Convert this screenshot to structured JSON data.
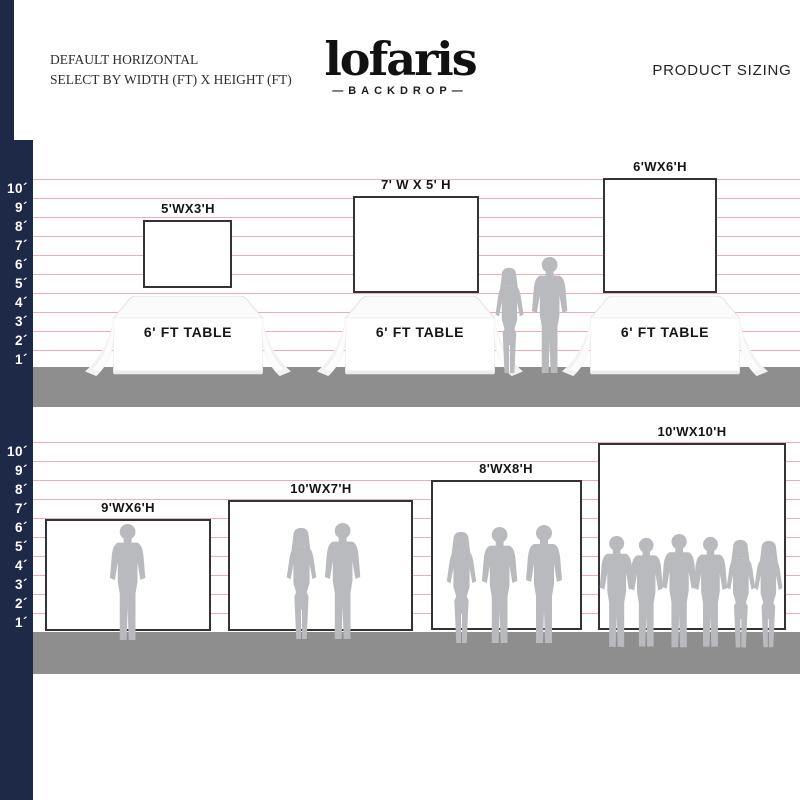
{
  "header": {
    "line1": "DEFAULT HORIZONTAL",
    "line2": "SELECT BY WIDTH (FT) X HEIGHT (FT)",
    "logo": "lofaris",
    "logo_sub": "—BACKDROP—",
    "right": "PRODUCT SIZING"
  },
  "scale": {
    "unit": "ft",
    "labels": [
      "10´",
      "9´",
      "8´",
      "7´",
      "6´",
      "5´",
      "4´",
      "3´",
      "2´",
      "1´"
    ]
  },
  "top_section": {
    "backdrops": [
      {
        "label": "5'WX3'H",
        "width_ft": 5,
        "height_ft": 3
      },
      {
        "label": "7' W X 5' H",
        "width_ft": 7,
        "height_ft": 5
      },
      {
        "label": "6'WX6'H",
        "width_ft": 6,
        "height_ft": 6
      }
    ],
    "tables": [
      {
        "label": "6' FT TABLE"
      },
      {
        "label": "6' FT TABLE"
      },
      {
        "label": "6' FT TABLE"
      }
    ]
  },
  "bottom_section": {
    "backdrops": [
      {
        "label": "9'WX6'H",
        "width_ft": 9,
        "height_ft": 6
      },
      {
        "label": "10'WX7'H",
        "width_ft": 10,
        "height_ft": 7
      },
      {
        "label": "8'WX8'H",
        "width_ft": 8,
        "height_ft": 8
      },
      {
        "label": "10'WX10'H",
        "width_ft": 10,
        "height_ft": 10
      }
    ]
  },
  "colors": {
    "accent_navy": "#1e2947",
    "ruler_pink": "#f0a9bd",
    "floor_gray": "#8e8e8e",
    "silhouette_gray": "#b8babd",
    "backdrop_border": "#333333"
  }
}
